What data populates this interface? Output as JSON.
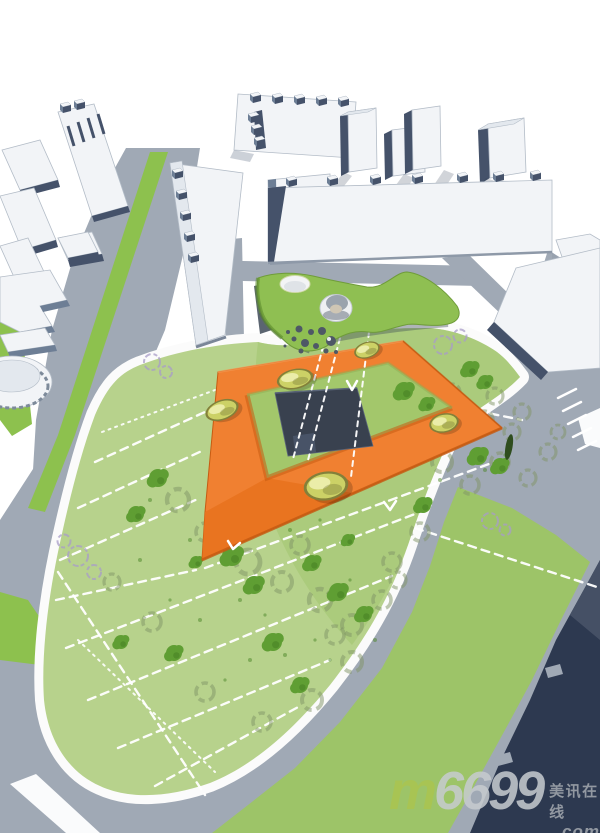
{
  "watermark": {
    "brand_m": "m",
    "brand_number": "6699",
    "tagline": "美讯在线",
    "domain_suffix": ".com"
  },
  "colors": {
    "background": "#ffffff",
    "plaza_white": "#fafbfc",
    "road": "#a0a9b5",
    "road_dark": "#97a1ae",
    "median_green": "#8dc14e",
    "park_green": "#b7d28c",
    "park_green_dark": "#a4c771",
    "court_green": "#a3c76b",
    "strip_green": "#9dc468",
    "canopy_green": "#8fbf52",
    "canopy_edge": "#6f9c3a",
    "canopy_shadow": "#3e4a58",
    "path_white": "#fbfbfb",
    "orange_top": "#f08031",
    "orange_wing": "#e8721f",
    "orange_dark": "#c65b12",
    "orange_light": "#f79c55",
    "court_square": "#39414f",
    "square_edge": "#5a6579",
    "dome_rim": "#83803a",
    "dome_fill": "#ccd166",
    "dome_light": "#eef0b0",
    "dome_shadow": "#6c7033",
    "tree_green": "#5f9e33",
    "tree_green_dark": "#4c8627",
    "tree_shadow": "#7f9465",
    "cypress": "#2f4d1e",
    "purple_tree": "#a89cc8",
    "building_white": "#f2f4f7",
    "building_roof": "#e3e8ee",
    "building_face": "#6d7e95",
    "building_face_dark": "#45526a",
    "building_outline": "#b3bcc7",
    "building_shadow": "#8d99a9",
    "navy": "#2d3950",
    "navy_light": "#4a5569",
    "dash_white": "#ffffff",
    "wm_green": "#a9c452",
    "wm_gray": "#c7cbd0",
    "wm_text": "#9aa0a8"
  }
}
